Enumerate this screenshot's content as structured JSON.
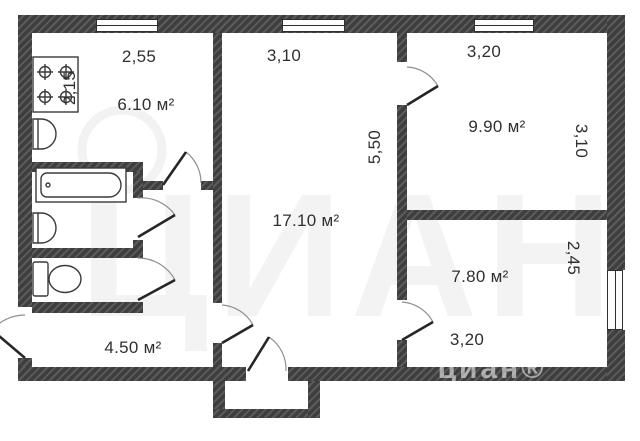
{
  "rooms": {
    "kitchen": {
      "area": "6.10 м²",
      "width": "2,55",
      "depth": "2,15"
    },
    "living": {
      "area": "17.10 м²",
      "width": "3,10",
      "depth": "5,50"
    },
    "bedroom_top_right": {
      "area": "9.90 м²",
      "width": "3,20",
      "depth": "3,10"
    },
    "bedroom_bottom_right": {
      "area": "7.80 м²",
      "width": "3,20",
      "depth": "2,45"
    },
    "hallway": {
      "area": "4.50 м²"
    }
  },
  "watermark": {
    "large": "ЦИАН",
    "small": "циан®"
  },
  "fixtures": [
    "stove-icon",
    "kitchen-sink-icon",
    "bathtub-icon",
    "bathroom-sink-icon",
    "toilet-icon"
  ],
  "colors": {
    "wall": "#3e3e3e",
    "wall_hatch": "#5b5b5b",
    "line": "#2b2b2b",
    "dim_text": "#303030"
  }
}
